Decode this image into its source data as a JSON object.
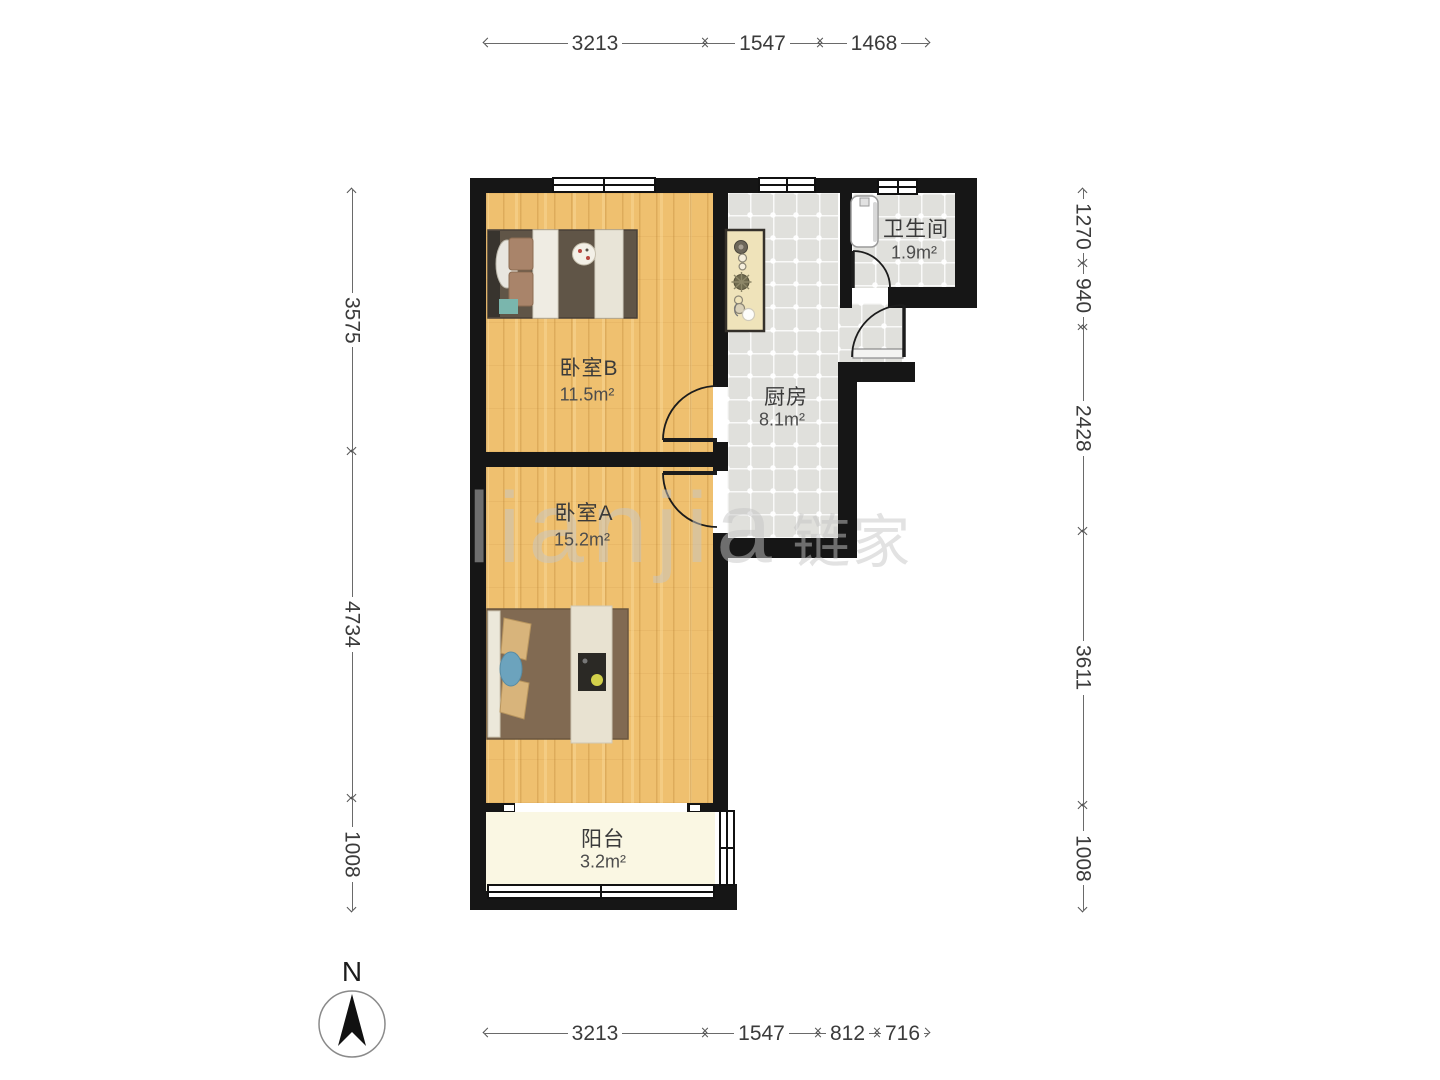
{
  "title": "两室户型图",
  "rooms": [
    {
      "id": "bedroom-b",
      "name": "卧室B",
      "area": "11.5m²"
    },
    {
      "id": "bedroom-a",
      "name": "卧室A",
      "area": "15.2m²"
    },
    {
      "id": "kitchen",
      "name": "厨房",
      "area": "8.1m²"
    },
    {
      "id": "bathroom",
      "name": "卫生间",
      "area": "1.9m²"
    },
    {
      "id": "balcony",
      "name": "阳台",
      "area": "3.2m²"
    }
  ],
  "dimensions": {
    "top": [
      "3213",
      "1547",
      "1468"
    ],
    "bottom": [
      "3213",
      "1547",
      "812",
      "716"
    ],
    "left": [
      "3575",
      "4734",
      "1008"
    ],
    "right": [
      "1270",
      "940",
      "2428",
      "3611",
      "1008"
    ]
  },
  "compass": {
    "label": "N"
  },
  "watermark": {
    "latin": "lianjia",
    "cjk": "链家"
  },
  "colors": {
    "wall": "#161616",
    "wood_floor": "#efc06f",
    "tile_floor": "#e0e0dc",
    "balcony_floor": "#faf7e3",
    "dimension_text": "#3b3b3b",
    "watermark": "#c6c6c6"
  }
}
